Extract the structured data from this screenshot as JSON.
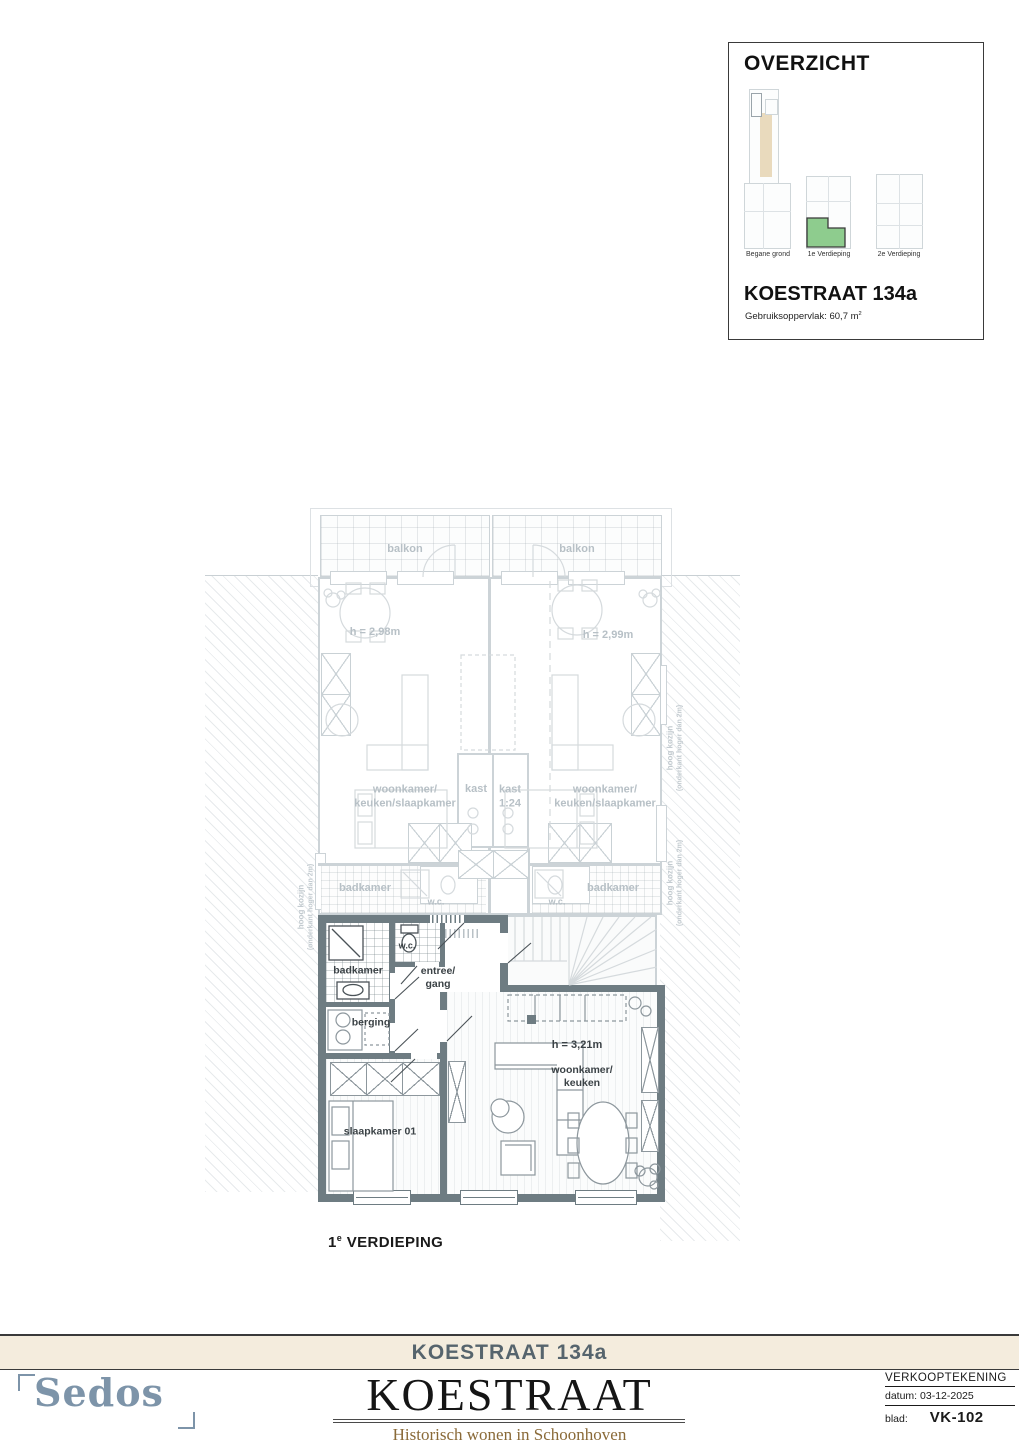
{
  "overzicht": {
    "title": "OVERZICHT",
    "floors": [
      {
        "label": "Begane grond"
      },
      {
        "label": "1e Verdieping"
      },
      {
        "label": "2e Verdieping"
      }
    ],
    "address": "KOESTRAAT 134a",
    "area_prefix": "Gebruiksoppervlak: 60,7 m",
    "area_sup": "2",
    "highlight_color": "#8ecc8e"
  },
  "plan": {
    "balkon_left": "balkon",
    "balkon_right": "balkon",
    "height_left": "h = 2,98m",
    "height_right": "h = 2,99m",
    "room_left": "woonkamer/\nkeuken/slaapkamer",
    "room_right": "woonkamer/\nkeuken/slaapkamer",
    "kast_left": "kast",
    "kast_right": "kast\n1:24",
    "badkamer_muted_left": "badkamer",
    "badkamer_muted_right": "badkamer",
    "wc_muted_left": "w.c.",
    "wc_muted_right": "w.c.",
    "hoog_kozijn": "hoog kozijn",
    "hoog_kozijn_sub": "(onderkant hoger dan 2m)",
    "badkamer": "badkamer",
    "wc": "w.c.",
    "entree": "entree/\ngang",
    "berging": "berging",
    "slaapkamer": "slaapkamer 01",
    "woonkamer": "woonkamer/\nkeuken",
    "height_main": "h = 3,21m",
    "wall_color": "#6e7c82",
    "floor_num": "1",
    "floor_sup": "e",
    "floor_rest": " VERDIEPING"
  },
  "footer": {
    "bar_title": "KOESTRAAT 134a",
    "logo": "Sedos",
    "title": "KOESTRAAT",
    "subtitle": "Historisch wonen in Schoonhoven",
    "doc_type": "VERKOOPTEKENING",
    "date": "datum: 03-12-2025",
    "sheet_label": "blad:",
    "sheet_value": "VK-102"
  }
}
